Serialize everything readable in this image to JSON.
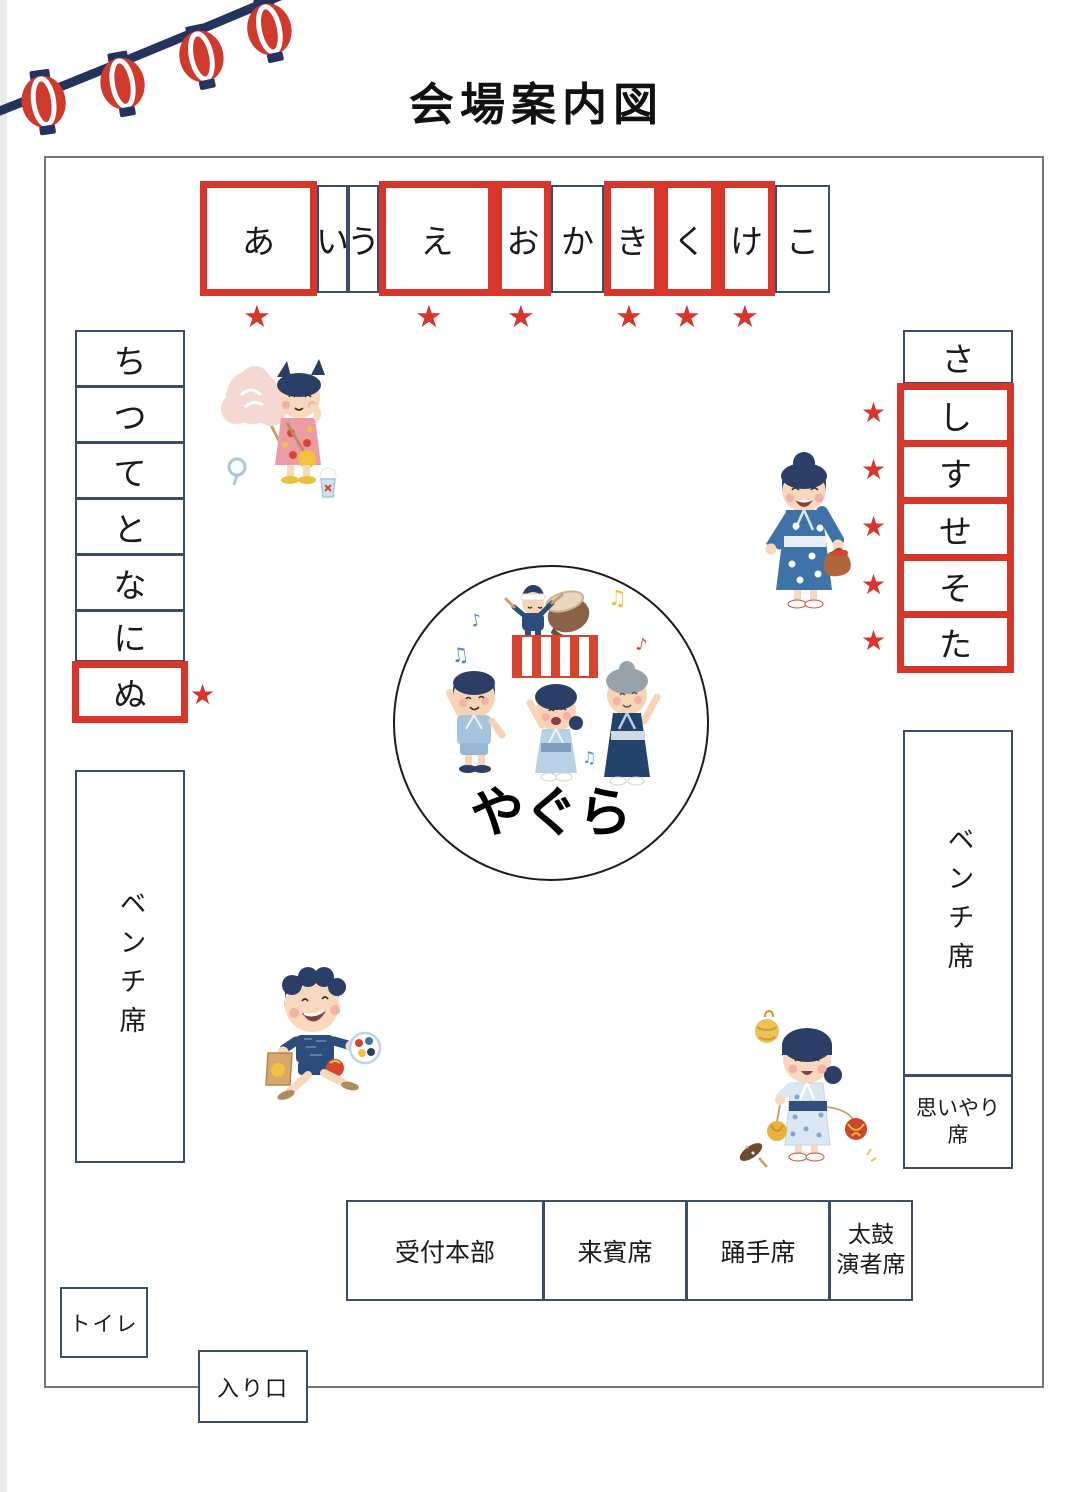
{
  "title": "会場案内図",
  "icons": {
    "star": "★",
    "note_single": "♪",
    "note_double": "♫"
  },
  "colors": {
    "highlight_red": "#d8352b",
    "line_navy": "#3b4d68",
    "map_border_gray": "#757575",
    "lantern_navy": "#27335f",
    "lantern_red": "#cf3a2c"
  },
  "stalls": {
    "top": [
      {
        "label": "あ",
        "highlighted": true,
        "starred": true
      },
      {
        "label": "い",
        "highlighted": false,
        "starred": false
      },
      {
        "label": "う",
        "highlighted": false,
        "starred": false
      },
      {
        "label": "え",
        "highlighted": true,
        "starred": true
      },
      {
        "label": "お",
        "highlighted": true,
        "starred": true
      },
      {
        "label": "か",
        "highlighted": false,
        "starred": false
      },
      {
        "label": "き",
        "highlighted": true,
        "starred": true
      },
      {
        "label": "く",
        "highlighted": true,
        "starred": true
      },
      {
        "label": "け",
        "highlighted": true,
        "starred": true
      },
      {
        "label": "こ",
        "highlighted": false,
        "starred": false
      }
    ],
    "left": [
      {
        "label": "ち",
        "highlighted": false,
        "starred": false
      },
      {
        "label": "つ",
        "highlighted": false,
        "starred": false
      },
      {
        "label": "て",
        "highlighted": false,
        "starred": false
      },
      {
        "label": "と",
        "highlighted": false,
        "starred": false
      },
      {
        "label": "な",
        "highlighted": false,
        "starred": false
      },
      {
        "label": "に",
        "highlighted": false,
        "starred": false
      },
      {
        "label": "ぬ",
        "highlighted": true,
        "starred": true
      }
    ],
    "right": [
      {
        "label": "さ",
        "highlighted": false,
        "starred": false
      },
      {
        "label": "し",
        "highlighted": true,
        "starred": true
      },
      {
        "label": "す",
        "highlighted": true,
        "starred": true
      },
      {
        "label": "せ",
        "highlighted": true,
        "starred": true
      },
      {
        "label": "そ",
        "highlighted": true,
        "starred": true
      },
      {
        "label": "た",
        "highlighted": true,
        "starred": true
      }
    ]
  },
  "center_stage": {
    "label": "やぐら"
  },
  "benches": {
    "left_label": "ベンチ席",
    "right_label": "ベンチ席"
  },
  "courtesy_seat_label": "思いやり\n席",
  "bottom_areas": [
    {
      "label": "受付本部"
    },
    {
      "label": "来賓席"
    },
    {
      "label": "踊手席"
    },
    {
      "label": "太鼓\n演者席"
    }
  ],
  "toilet_label": "トイレ",
  "entrance_label": "入り口"
}
